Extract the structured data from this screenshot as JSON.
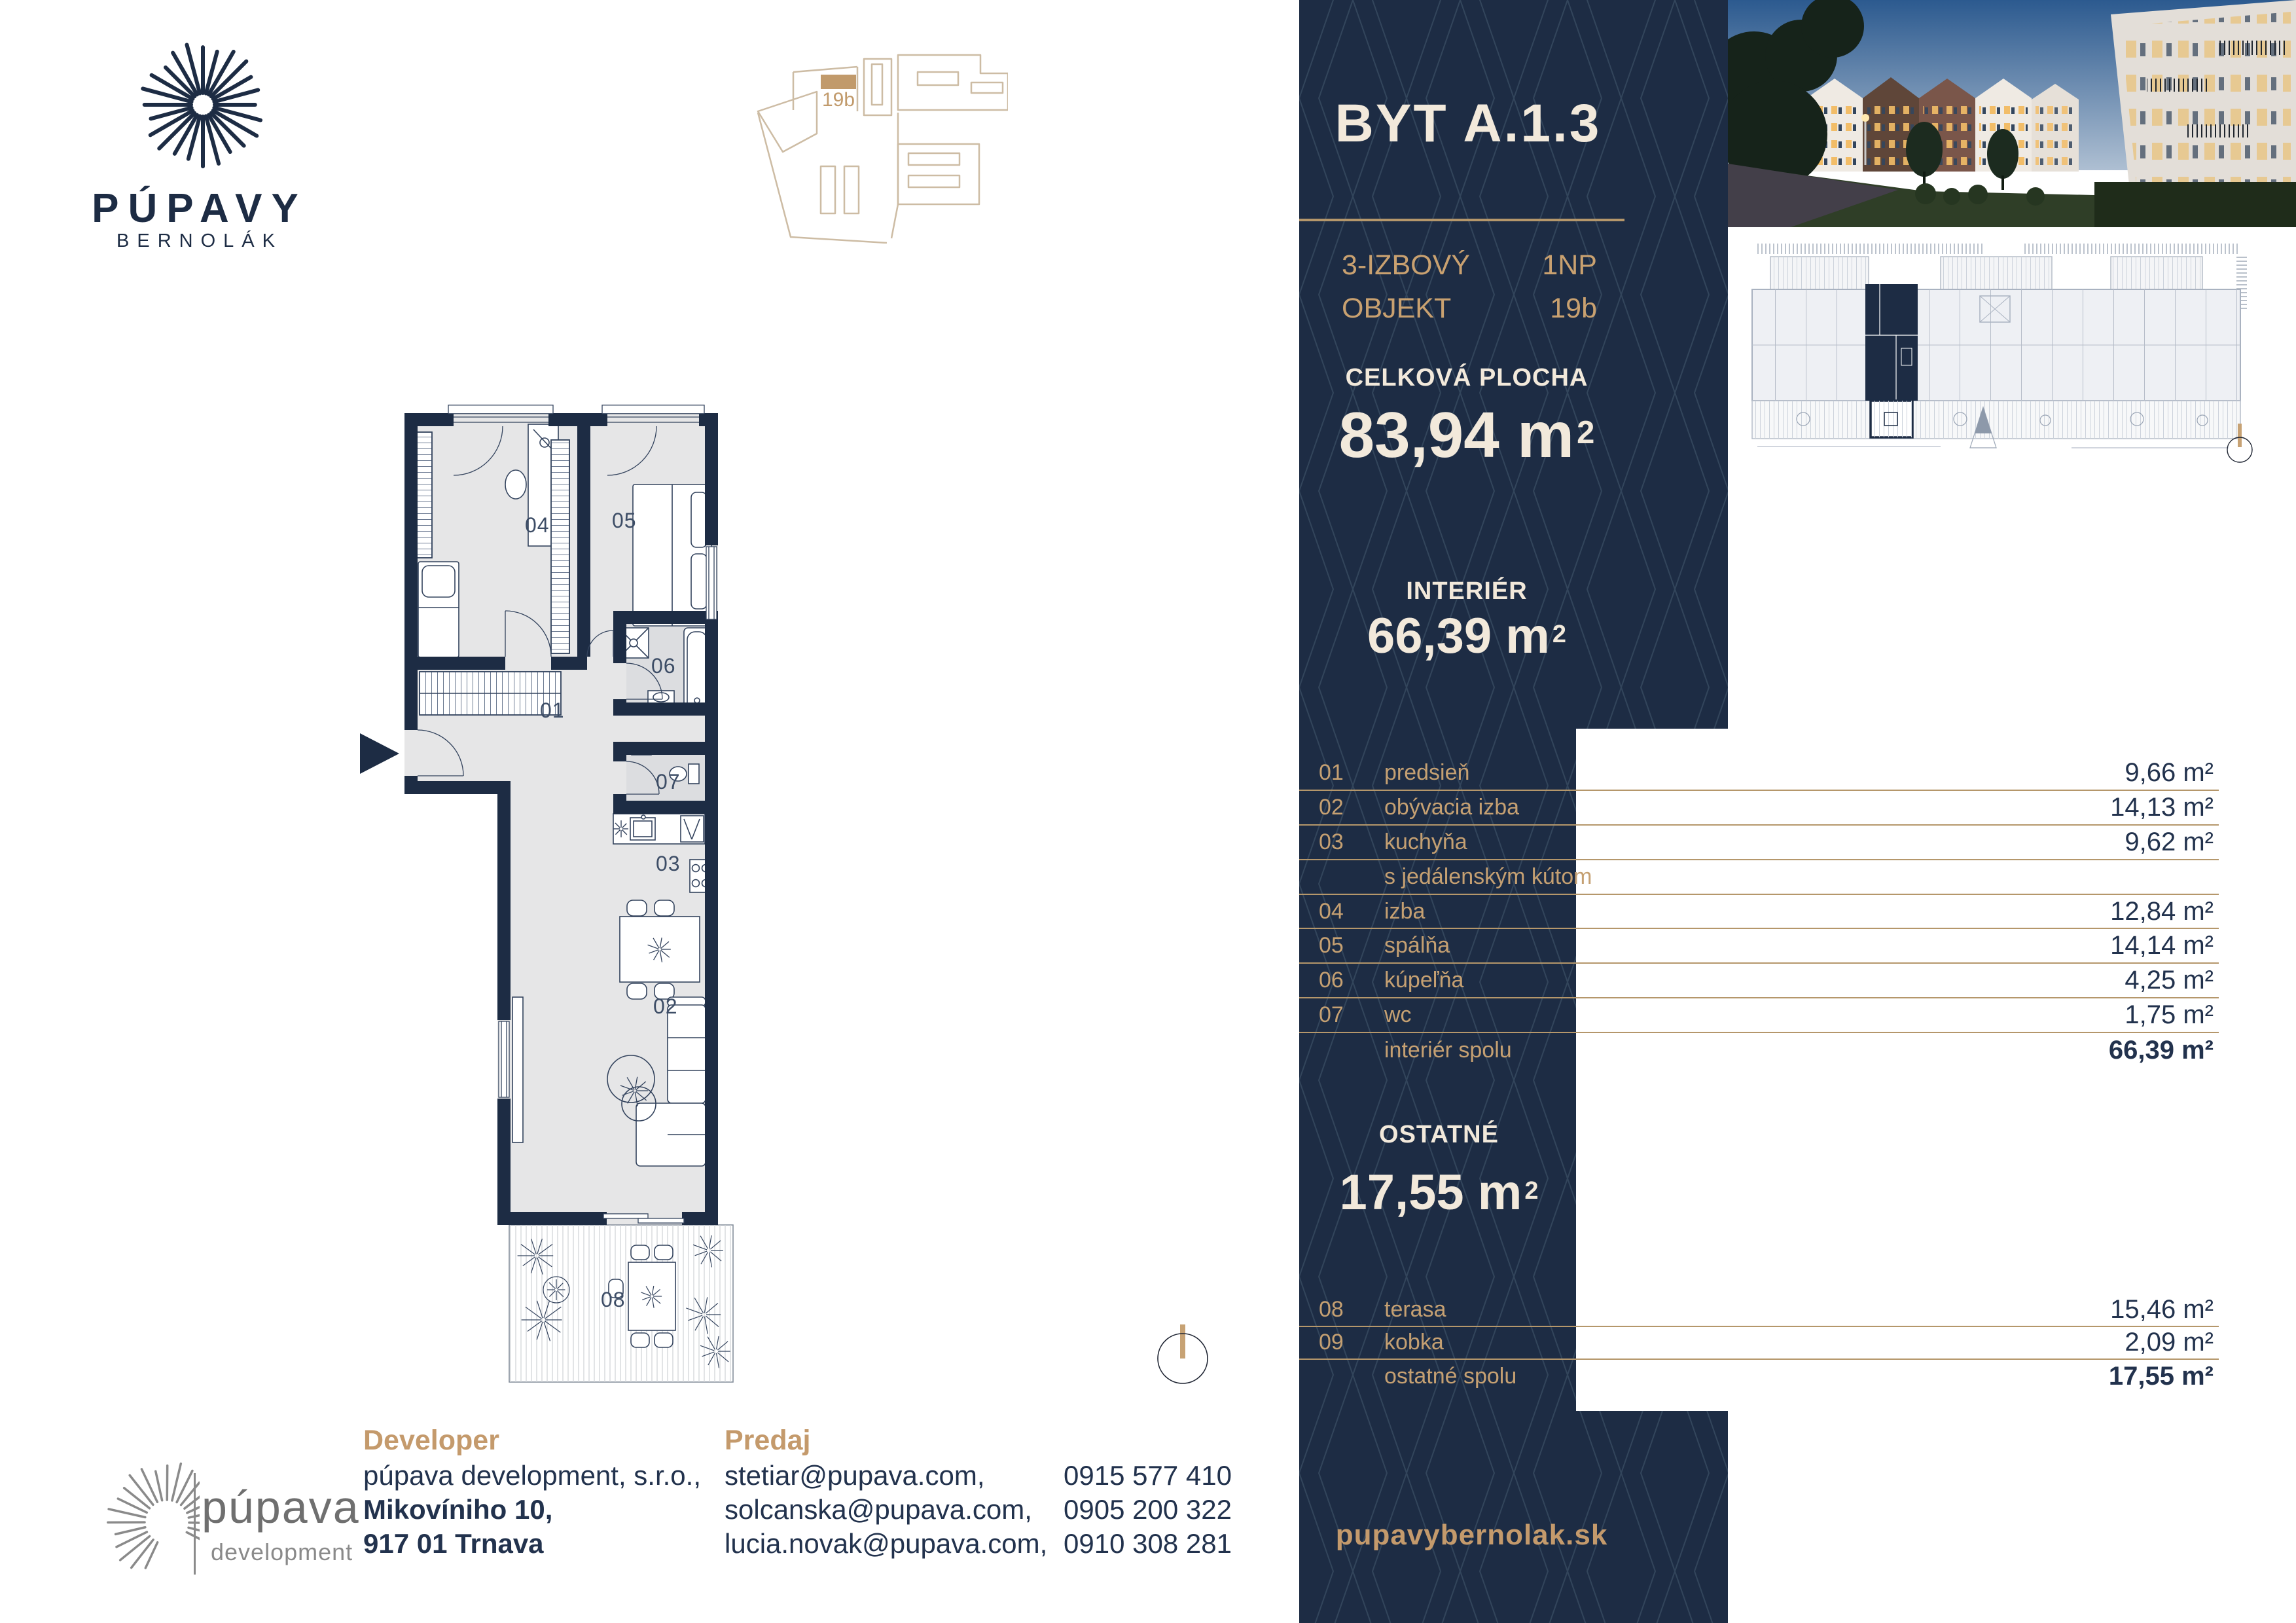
{
  "colors": {
    "navy": "#1d2c44",
    "gold": "#c49a6c",
    "cream": "#f2e9db"
  },
  "brand": {
    "name": "PÚPAVY",
    "sub": "BERNOLÁK"
  },
  "site_plan": {
    "label": "19b"
  },
  "panel": {
    "title": "BYT A.1.3",
    "type": "3-IZBOVÝ",
    "object": "OBJEKT",
    "floor": "1NP",
    "building": "19b",
    "total_label": "CELKOVÁ PLOCHA",
    "total_value": "83,94 m",
    "interior_label": "INTERIÉR",
    "interior_value": "66,39 m",
    "other_label": "OSTATNÉ",
    "other_value": "17,55 m",
    "sup": "2",
    "website": "pupavybernolak.sk"
  },
  "rooms_interior": [
    {
      "num": "01",
      "name": "predsieň",
      "area": "9,66 m²"
    },
    {
      "num": "02",
      "name": "obývacia izba",
      "area": "14,13 m²"
    },
    {
      "num": "03",
      "name": "kuchyňa",
      "area": "9,62 m²"
    },
    {
      "num": "",
      "name": "s jedálenským kútom",
      "area": ""
    },
    {
      "num": "04",
      "name": "izba",
      "area": "12,84 m²"
    },
    {
      "num": "05",
      "name": "spálňa",
      "area": "14,14 m²"
    },
    {
      "num": "06",
      "name": "kúpeľňa",
      "area": "4,25 m²"
    },
    {
      "num": "07",
      "name": "wc",
      "area": "1,75 m²"
    },
    {
      "num": "",
      "name": "interiér spolu",
      "area": "66,39 m²",
      "bold": true
    }
  ],
  "rooms_other": [
    {
      "num": "08",
      "name": "terasa",
      "area": "15,46 m²"
    },
    {
      "num": "09",
      "name": "kobka",
      "area": "2,09 m²"
    },
    {
      "num": "",
      "name": "ostatné spolu",
      "area": "17,55 m²",
      "bold": true
    }
  ],
  "floorplan": {
    "labels": [
      "01",
      "02",
      "03",
      "04",
      "05",
      "06",
      "07",
      "08"
    ]
  },
  "footer": {
    "developer_label": "Developer",
    "developer_lines": [
      "púpava development, s.r.o.,",
      "Mikovíniho 10,",
      "917 01 Trnava"
    ],
    "predaj_label": "Predaj",
    "emails": [
      "stetiar@pupava.com,",
      "solcanska@pupava.com,",
      "lucia.novak@pupava.com,"
    ],
    "phones": [
      "0915 577 410",
      "0905 200 322",
      "0910 308 281"
    ],
    "logo_text": "púpava",
    "logo_sub": "development"
  }
}
